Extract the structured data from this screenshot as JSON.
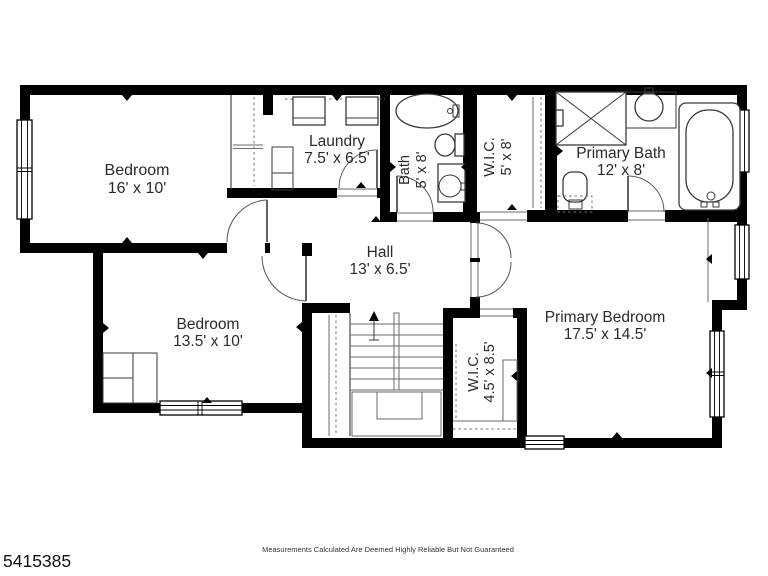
{
  "floorplan": {
    "title": "second-floor-plan",
    "colors": {
      "wall": "#000000",
      "line": "#3a3a3a",
      "background": "#ffffff"
    },
    "rooms": [
      {
        "id": "bedroom-1",
        "name": "Bedroom",
        "dims": "16' x 10'"
      },
      {
        "id": "laundry",
        "name": "Laundry",
        "dims": "7.5' x 6.5'"
      },
      {
        "id": "bath",
        "name": "Bath",
        "dims": "5' x 8'"
      },
      {
        "id": "wic-upper",
        "name": "W.I.C.",
        "dims": "5' x 8'"
      },
      {
        "id": "primary-bath",
        "name": "Primary Bath",
        "dims": "12' x 8'"
      },
      {
        "id": "hall",
        "name": "Hall",
        "dims": "13' x 6.5'"
      },
      {
        "id": "bedroom-2",
        "name": "Bedroom",
        "dims": "13.5' x 10'"
      },
      {
        "id": "primary-bedroom",
        "name": "Primary Bedroom",
        "dims": "17.5' x 14.5'"
      },
      {
        "id": "wic-primary",
        "name": "W.I.C.",
        "dims": "4.5' x 8.5'"
      }
    ]
  },
  "footer": {
    "listing_id": "5415385",
    "disclaimer": "Measurements Calculated Are Deemed Highly Reliable But Not Guaranteed"
  }
}
